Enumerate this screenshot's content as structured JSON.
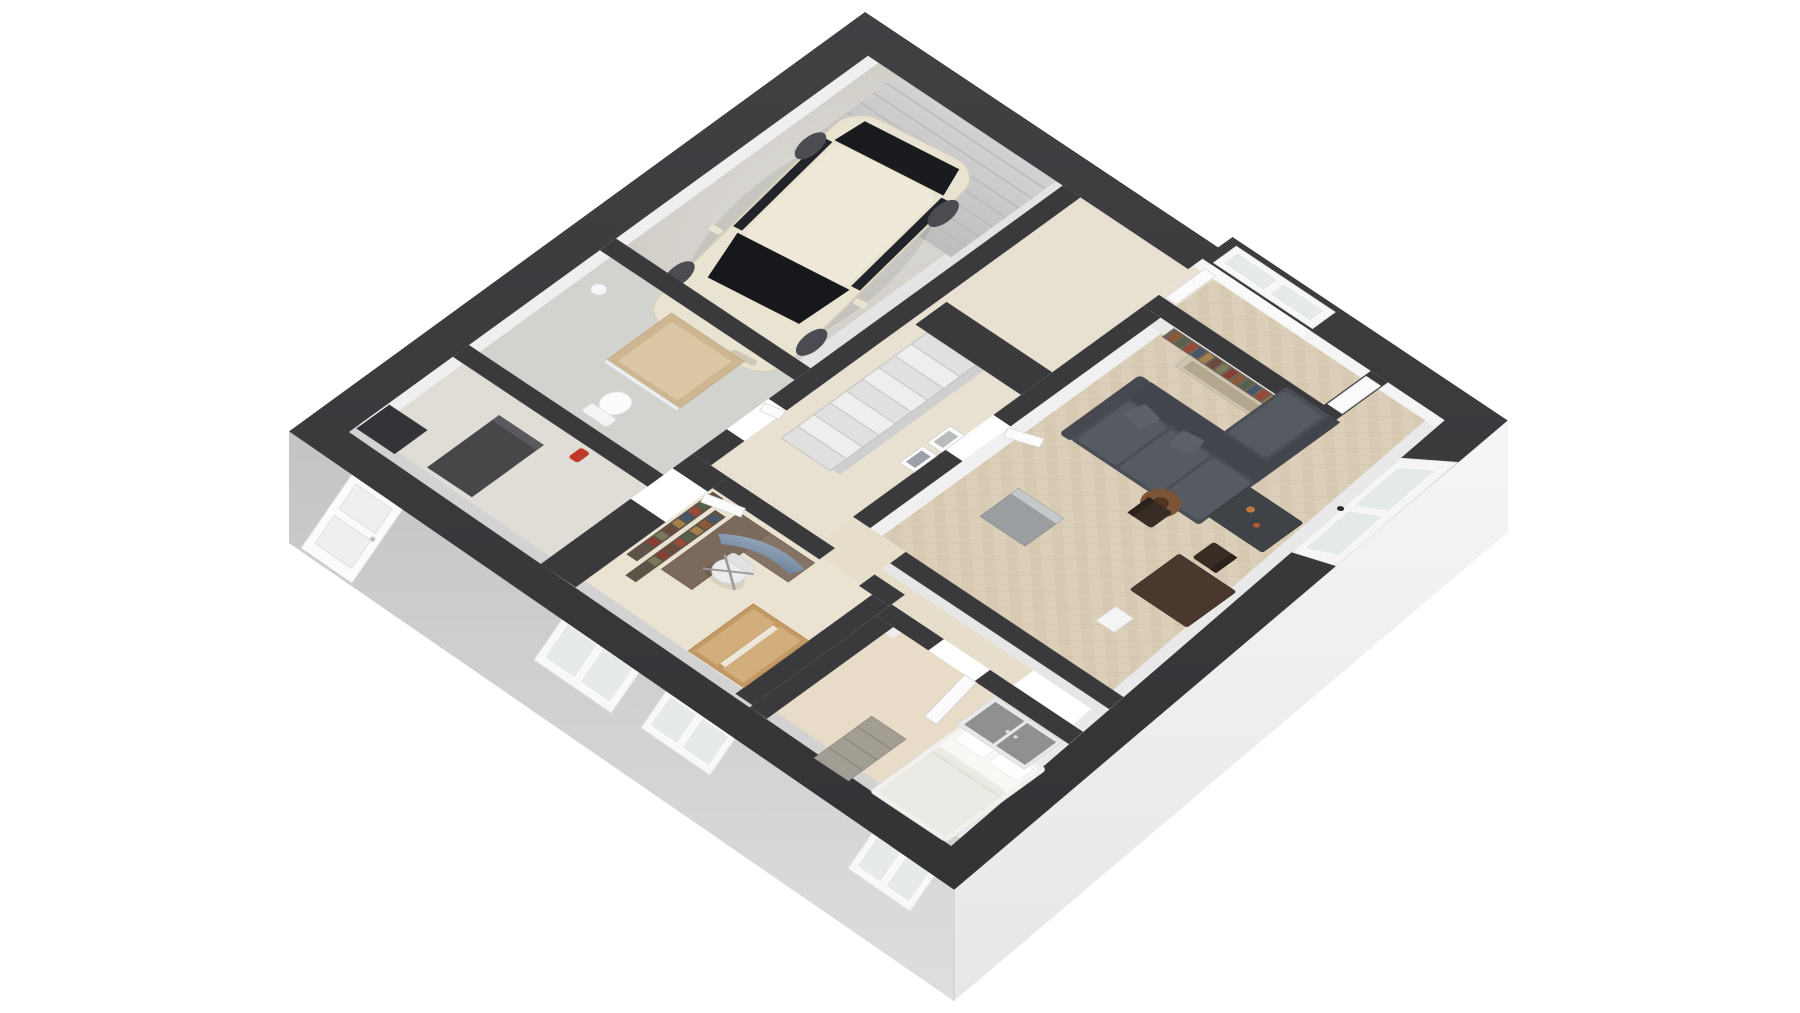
{
  "scene": {
    "type": "3d-floor-plan-render",
    "view": "isometric-cutaway",
    "floor": "ground-floor",
    "background": "#ffffff"
  },
  "colors": {
    "wall_top": "#3a3a3d",
    "wall_top_light": "#454548",
    "wall_face_lit": "#f4f4f4",
    "wall_face_shadow": "#d2d2d2",
    "skirt_left": "#c9c9c9",
    "skirt_right": "#f2f2f2",
    "floor_concrete": "#d8d6d1",
    "floor_wood": "#e8e0d0",
    "floor_wood_office": "#ebe3d2",
    "floor_wood_bedroom": "#e8dcc8",
    "floor_tile_bath": "#d2d2cf",
    "floor_utility": "#e0ddd7",
    "garage_door": "#c9c9c9",
    "sofa": "#4b4e54",
    "sofa_cushion": "#565a61",
    "coffee_table": "#3f4347",
    "dining_table": "#4a382e",
    "dining_chair": "#382d24",
    "lamp_shade": "#7b5336",
    "shelf_board": "#6e6156",
    "artwork": "#cfc5b4",
    "sideboard": "#9a9ea0",
    "car_body": "#e9e3d2",
    "car_glass": "#17181c",
    "wheel": "#4a4c52",
    "oak": "#c39a66",
    "oak_light": "#d2ae7c",
    "bed": "#f2f1ee",
    "dresser": "#a39e94",
    "wardrobe_gray": "#8e9092",
    "desk_wood": "#857465",
    "monitor_blue": "#8fa3b8",
    "chair_white": "#ececec",
    "shower_tile": "#cdb691",
    "toilet": "#fbfbfb",
    "counter_dark": "#474749",
    "extinguisher": "#c0392b",
    "window_frame": "#f7f7f7",
    "window_pane": "#e7eaea"
  },
  "rooms": [
    {
      "name": "garage",
      "furniture": [
        "suv-car",
        "garage-door",
        "concrete-floor"
      ]
    },
    {
      "name": "entry-corridor",
      "furniture": [
        "door-leaf",
        "door-leaf"
      ]
    },
    {
      "name": "stair-hall",
      "furniture": [
        "staircase",
        "picture-frames"
      ]
    },
    {
      "name": "living-room",
      "furniture": [
        "sectional-sofa",
        "chaise",
        "coffee-table",
        "dining-table",
        "dining-chairs",
        "floor-lamp",
        "bookshelf",
        "artwork",
        "sideboard",
        "window-ne",
        "window-se"
      ]
    },
    {
      "name": "bathroom",
      "furniture": [
        "shower",
        "toilet"
      ]
    },
    {
      "name": "office",
      "furniture": [
        "corner-desk",
        "curved-monitor",
        "office-chair",
        "wall-bookshelves",
        "oak-wardrobe"
      ]
    },
    {
      "name": "utility-room",
      "furniture": [
        "dark-counter",
        "boiler-unit",
        "fire-extinguisher"
      ]
    },
    {
      "name": "bedroom",
      "furniture": [
        "double-bed",
        "gray-wardrobe",
        "rustic-dresser",
        "open-door"
      ]
    }
  ],
  "counts": {
    "stair_steps": 9,
    "living_shelf_books": 16,
    "office_shelf_books": 16,
    "sw_windows": 3,
    "sw_doors": 1
  }
}
